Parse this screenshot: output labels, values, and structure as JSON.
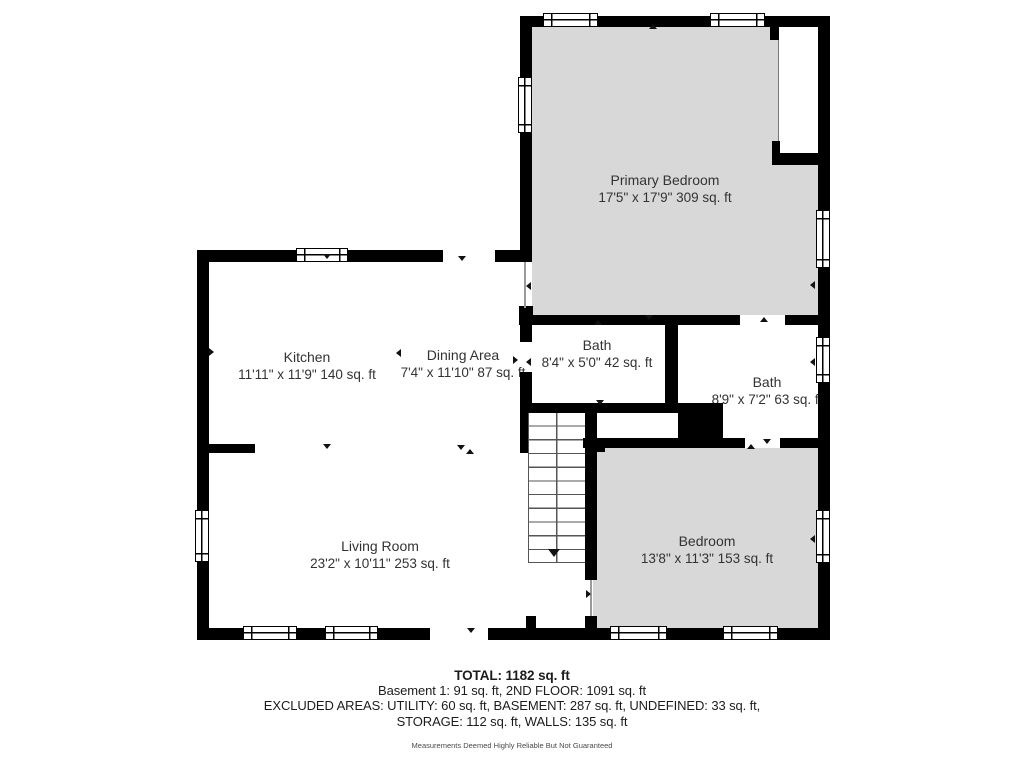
{
  "rooms": [
    {
      "name": "Primary Bedroom",
      "dims": "17'5\" x 17'9\" 309 sq. ft"
    },
    {
      "name": "Kitchen",
      "dims": "11'11\" x 11'9\" 140 sq. ft"
    },
    {
      "name": "Dining Area",
      "dims": "7'4\" x 11'10\" 87 sq. ft"
    },
    {
      "name": "Bath",
      "dims": "8'4\" x 5'0\" 42 sq. ft"
    },
    {
      "name": "Bath",
      "dims": "8'9\" x 7'2\" 63 sq. ft"
    },
    {
      "name": "Living Room",
      "dims": "23'2\" x 10'11\" 253 sq. ft"
    },
    {
      "name": "Bedroom",
      "dims": "13'8\" x 11'3\" 153 sq. ft"
    }
  ],
  "footer": {
    "total": "TOTAL: 1182 sq. ft",
    "line2": "Basement 1: 91 sq. ft, 2ND FLOOR: 1091 sq. ft",
    "line3": "EXCLUDED AREAS: UTILITY: 60 sq. ft, BASEMENT: 287 sq. ft, UNDEFINED: 33 sq. ft,",
    "line4": "STORAGE: 112 sq. ft, WALLS: 135 sq. ft",
    "disclaimer": "Measurements Deemed Highly Reliable But Not Guaranteed"
  },
  "colors": {
    "wall": "#000000",
    "room_fill": "#d8d8d8",
    "label_text": "#333333",
    "marker": "#111111"
  }
}
